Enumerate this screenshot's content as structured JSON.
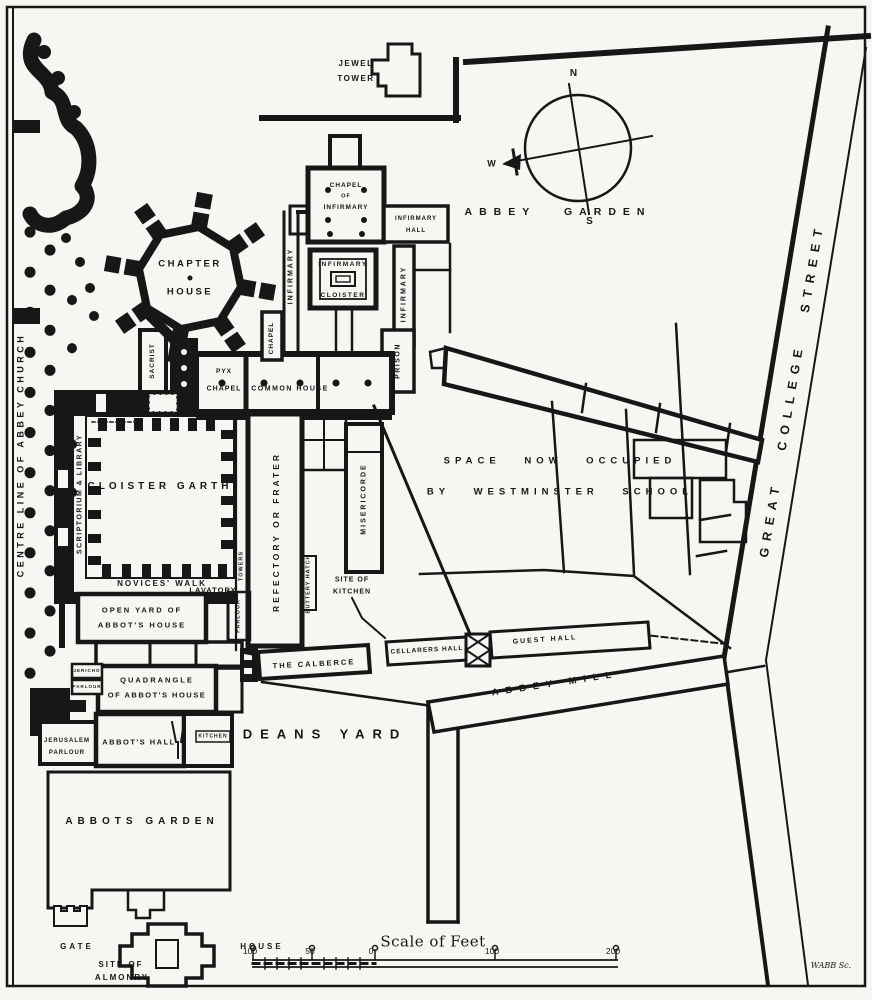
{
  "title": "Plan of Westminster Abbey and its precincts",
  "colors": {
    "ink": "#171717",
    "paper": "#f7f6f2"
  },
  "compass": {
    "north": "N",
    "south": "S",
    "west": "W"
  },
  "labels": {
    "centre_line": "CENTRE LINE OF ABBEY CHURCH",
    "jewel_1": "JEWEL",
    "jewel_2": "TOWER",
    "abbey_garden": "ABBEY GARDEN",
    "chapter_1": "CHAPTER",
    "chapter_2": "HOUSE",
    "chapel_inf_1": "CHAPEL",
    "chapel_inf_2": "OF",
    "chapel_inf_3": "INFIRMARY",
    "inf_hall_1": "INFIRMARY",
    "inf_hall_2": "HALL",
    "infirmary_left": "INFIRMARY",
    "infirmary_right": "INFIRMARY",
    "inf_cloister_1": "INFIRMARY",
    "inf_cloister_2": "CLOISTER",
    "chapel_vert": "CHAPEL",
    "prison": "PRISON",
    "sacrist": "SACRIST",
    "pyx_1": "PYX",
    "pyx_2": "CHAPEL",
    "common_house": "COMMON HOUSE",
    "scriptorium": "SCRIPTORIUM & LIBRARY",
    "cloister_garth": "CLOISTER GARTH",
    "novices_walk": "NOVICES' WALK",
    "lavatory": "LAVATORY",
    "towers": "TOWERS",
    "parlour_east": "PARLOUR",
    "refectory": "REFECTORY OR FRATER",
    "misericorde": "MISERICORDE",
    "buttery_hatch": "BUTTERY HATCH",
    "site_kitchen_1": "SITE OF",
    "site_kitchen_2": "KITCHEN",
    "school_1": "SPACE NOW OCCUPIED",
    "school_2": "BY WESTMINSTER SCHOOL",
    "calberce": "THE CALBERCE",
    "cellarers_hall": "CELLARERS HALL",
    "guest_hall": "GUEST HALL",
    "open_yard_1": "OPEN YARD OF",
    "open_yard_2": "ABBOT'S HOUSE",
    "quadrangle_1": "QUADRANGLE",
    "quadrangle_2": "OF ABBOT'S HOUSE",
    "jericho_1": "JERICHO",
    "jericho_2": "PARLOUR",
    "jerusalem_1": "JERUSALEM",
    "jerusalem_2": "PARLOUR",
    "abbots_hall": "ABBOT'S HALL",
    "kitchen": "KITCHEN",
    "deans_yard": "DEANS YARD",
    "abbey_mill": "ABBEY MILL",
    "abbots_garden": "ABBOTS GARDEN",
    "gate": "GATE",
    "house": "HOUSE",
    "almonry_1": "SITE OF",
    "almonry_2": "ALMONRY",
    "great_college_street": "GREAT COLLEGE STREET",
    "engraver": "WABB Sc."
  },
  "scale_bar": {
    "title": "Scale of Feet",
    "ticks": [
      "100",
      "50",
      "0",
      "100",
      "200"
    ]
  }
}
